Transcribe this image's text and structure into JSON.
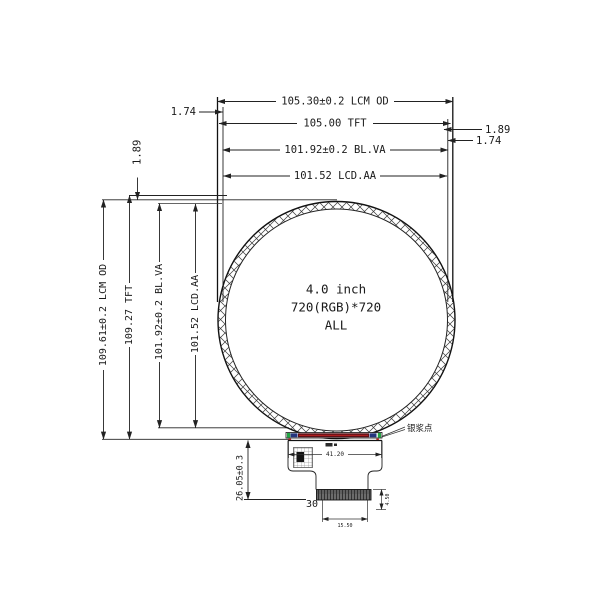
{
  "drawing": {
    "center": {
      "size": "4.0 inch",
      "resolution": "720(RGB)*720",
      "mode": "ALL"
    },
    "dim_top": {
      "lcm_od": "105.30±0.2 LCM OD",
      "tft": "105.00 TFT",
      "bl_va": "101.92±0.2 BL.VA",
      "lcd_aa": "101.52 LCD.AA",
      "left_offset": "1.74",
      "right_offset_1": "1.89",
      "right_offset_2": "1.74",
      "top_left_gap": "1.89"
    },
    "dim_left": {
      "lcm_od": "109.61±0.2 LCM OD",
      "tft": "109.27 TFT",
      "bl_va": "101.92±0.2 BL.VA",
      "lcd_aa": "101.52 LCD.AA"
    },
    "dim_bottom": {
      "fpc_width": "41.20",
      "tail_length": "26.05±0.3",
      "pin_count": "30",
      "tab_width": "15.50",
      "stiffener_height": "4.50"
    },
    "annotation": {
      "silver_paste_label": "银浆点"
    },
    "colors": {
      "line": "#222222",
      "bonding_strip": "#5a1016",
      "strip_center_line": "#c42222",
      "strip_cap_green": "#22a544",
      "strip_block_navy": "#25357e",
      "stiffener_gray": "#606060"
    }
  }
}
